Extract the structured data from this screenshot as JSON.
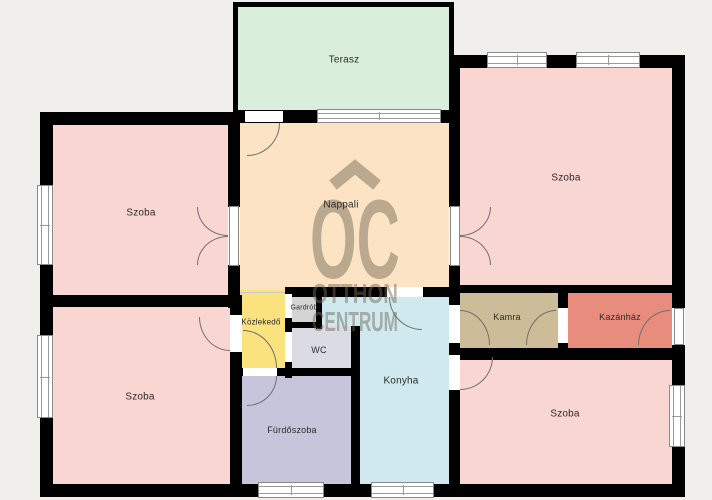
{
  "page": {
    "width": 712,
    "height": 500,
    "background": "#f0efeb",
    "wall_color": "#000000"
  },
  "watermark": {
    "letters": "OC",
    "word1": "OTTHON",
    "word2": "CENTRUM",
    "roof_icon": "roof-chevron",
    "color": "rgba(116,104,86,0.48)"
  },
  "rooms": [
    {
      "id": "terasz",
      "label": "Terasz",
      "color": "#d9efdb",
      "rect": [
        235,
        4,
        218,
        110
      ],
      "label_at": [
        344,
        60
      ],
      "fs": 10
    },
    {
      "id": "szoba-tl",
      "label": "Szoba",
      "color": "#f9d6d2",
      "rect": [
        46,
        117,
        188,
        185
      ],
      "label_at": [
        141,
        213
      ],
      "fs": 10
    },
    {
      "id": "nappali",
      "label": "Nappali",
      "color": "#fce3c4",
      "rect": [
        234,
        115,
        220,
        180
      ],
      "label_at": [
        341,
        205
      ],
      "fs": 10
    },
    {
      "id": "szoba-tr",
      "label": "Szoba",
      "color": "#f9d6d2",
      "rect": [
        454,
        62,
        224,
        230
      ],
      "label_at": [
        566,
        178
      ],
      "fs": 10
    },
    {
      "id": "kozlekedo",
      "label": "Közlekedő",
      "color": "#fae27f",
      "rect": [
        236,
        290,
        53,
        84
      ],
      "label_at": [
        261,
        322
      ],
      "fs": 8
    },
    {
      "id": "gardrob",
      "label": "Gardrób",
      "color": "#d4d4d4",
      "rect": [
        291,
        294,
        26,
        29
      ],
      "label_at": [
        304,
        308
      ],
      "fs": 7
    },
    {
      "id": "wc",
      "label": "WC",
      "color": "#dbdbe5",
      "rect": [
        292,
        326,
        60,
        45
      ],
      "label_at": [
        319,
        350
      ],
      "fs": 9
    },
    {
      "id": "konyha-nook",
      "label": "",
      "color": "#cfe9ee",
      "rect": [
        320,
        294,
        40,
        32
      ],
      "label_at": [
        -100,
        -100
      ],
      "fs": 9
    },
    {
      "id": "konyha",
      "label": "Konyha",
      "color": "#cfe9ee",
      "rect": [
        358,
        294,
        92,
        192
      ],
      "label_at": [
        401,
        381
      ],
      "fs": 10
    },
    {
      "id": "kamra",
      "label": "Kamra",
      "color": "#ccbc97",
      "rect": [
        456,
        291,
        104,
        59
      ],
      "label_at": [
        507,
        317
      ],
      "fs": 9
    },
    {
      "id": "kazanhaz",
      "label": "Kazánház",
      "color": "#e88d7e",
      "rect": [
        566,
        291,
        108,
        59
      ],
      "label_at": [
        620,
        317
      ],
      "fs": 9
    },
    {
      "id": "szoba-bl",
      "label": "Szoba",
      "color": "#f9d6d2",
      "rect": [
        46,
        305,
        186,
        182
      ],
      "label_at": [
        140,
        397
      ],
      "fs": 10
    },
    {
      "id": "furdoszoba",
      "label": "Fürdőszoba",
      "color": "#c6c5dc",
      "rect": [
        238,
        374,
        114,
        112
      ],
      "label_at": [
        292,
        430
      ],
      "fs": 9
    },
    {
      "id": "szoba-br",
      "label": "Szoba",
      "color": "#f9d6d2",
      "rect": [
        458,
        358,
        216,
        128
      ],
      "label_at": [
        565,
        414
      ],
      "fs": 10
    }
  ],
  "walls": [
    [
      233,
      2,
      5,
      114
    ],
    [
      233,
      2,
      221,
      5
    ],
    [
      449,
      2,
      5,
      58
    ],
    [
      40,
      112,
      198,
      13
    ],
    [
      233,
      110,
      222,
      13
    ],
    [
      449,
      55,
      236,
      13
    ],
    [
      40,
      112,
      13,
      385
    ],
    [
      672,
      55,
      13,
      442
    ],
    [
      40,
      484,
      645,
      13
    ],
    [
      228,
      112,
      12,
      196
    ],
    [
      40,
      295,
      200,
      12
    ],
    [
      230,
      295,
      12,
      192
    ],
    [
      287,
      287,
      173,
      10
    ],
    [
      449,
      60,
      11,
      235
    ],
    [
      449,
      285,
      236,
      8
    ],
    [
      449,
      287,
      11,
      200
    ],
    [
      558,
      287,
      10,
      70
    ],
    [
      449,
      348,
      236,
      12
    ],
    [
      285,
      287,
      7,
      91
    ],
    [
      316,
      287,
      6,
      42
    ],
    [
      285,
      322,
      37,
      6
    ],
    [
      230,
      368,
      130,
      8
    ],
    [
      351,
      326,
      9,
      161
    ]
  ],
  "windows": [
    {
      "r": [
        37,
        185,
        16,
        80
      ],
      "d": "v"
    },
    {
      "r": [
        37,
        335,
        16,
        83
      ],
      "d": "v"
    },
    {
      "r": [
        487,
        52,
        60,
        16
      ],
      "d": "h"
    },
    {
      "r": [
        576,
        52,
        64,
        16
      ],
      "d": "h"
    },
    {
      "r": [
        317,
        109,
        124,
        14
      ],
      "d": "h"
    },
    {
      "r": [
        669,
        385,
        16,
        62
      ],
      "d": "v"
    },
    {
      "r": [
        258,
        482,
        66,
        16
      ],
      "d": "h"
    },
    {
      "r": [
        371,
        482,
        63,
        16
      ],
      "d": "h"
    }
  ],
  "door_gaps": [
    [
      245,
      111,
      38,
      11
    ],
    [
      228,
      207,
      12,
      58
    ],
    [
      449,
      207,
      11,
      58
    ],
    [
      387,
      287,
      36,
      10
    ],
    [
      230,
      315,
      12,
      37
    ],
    [
      285,
      294,
      7,
      24
    ],
    [
      285,
      332,
      7,
      30
    ],
    [
      449,
      305,
      11,
      38
    ],
    [
      558,
      308,
      10,
      35
    ],
    [
      672,
      308,
      13,
      37
    ],
    [
      449,
      355,
      11,
      35
    ],
    [
      243,
      368,
      34,
      8
    ]
  ],
  "door_leaves": [
    [
      229,
      206,
      10,
      60
    ],
    [
      450,
      206,
      10,
      60
    ],
    [
      674,
      308,
      10,
      37
    ]
  ],
  "door_arcs": [
    {
      "r": [
        247,
        123,
        33,
        33
      ],
      "c": "br"
    },
    {
      "r": [
        197,
        207,
        31,
        29
      ],
      "c": "bl"
    },
    {
      "r": [
        197,
        236,
        31,
        29
      ],
      "c": "tl"
    },
    {
      "r": [
        460,
        207,
        31,
        29
      ],
      "c": "br"
    },
    {
      "r": [
        460,
        236,
        31,
        29
      ],
      "c": "tr"
    },
    {
      "r": [
        389,
        297,
        33,
        33
      ],
      "c": "bl"
    },
    {
      "r": [
        243,
        330,
        34,
        38
      ],
      "c": "tr"
    },
    {
      "r": [
        247,
        376,
        30,
        30
      ],
      "c": "br"
    },
    {
      "r": [
        199,
        317,
        31,
        34
      ],
      "c": "bl"
    },
    {
      "r": [
        460,
        310,
        30,
        35
      ],
      "c": "tr"
    },
    {
      "r": [
        526,
        310,
        30,
        35
      ],
      "c": "tl"
    },
    {
      "r": [
        638,
        310,
        32,
        35
      ],
      "c": "tl"
    },
    {
      "r": [
        460,
        357,
        33,
        33
      ],
      "c": "br"
    }
  ],
  "lines": [
    [
      240,
      292,
      47,
      1
    ]
  ]
}
